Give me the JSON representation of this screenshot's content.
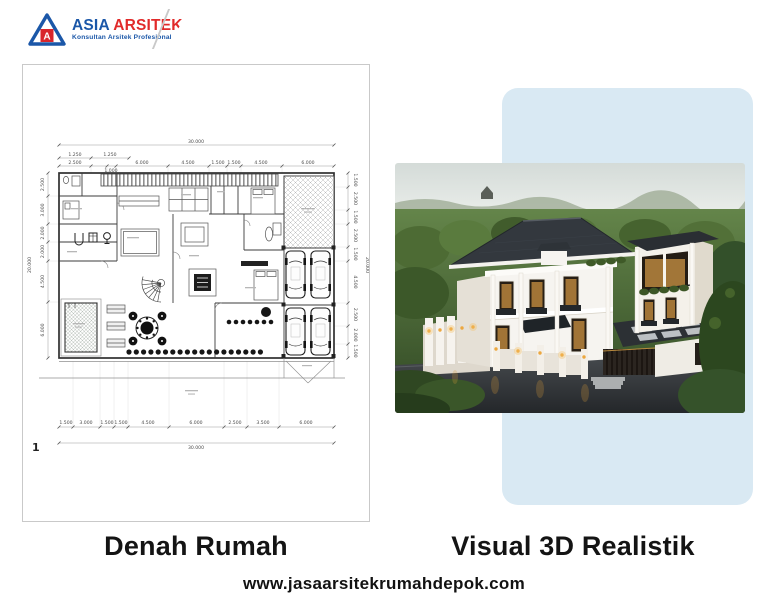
{
  "logo": {
    "mark_letter": "A",
    "brand_first": "ASIA",
    "brand_second": "ARSITEK",
    "tagline": "Konsultan Arsitek Profesional",
    "colors": {
      "blue": "#1b57a8",
      "red": "#e12a2a"
    }
  },
  "plan": {
    "sheet_number": "1",
    "width_total": "30.000",
    "height_total": "20.000",
    "top_sub_dims": [
      "1.250",
      "1.250"
    ],
    "top_offset_dim": "1.000",
    "top_dims": [
      "2.500",
      "6.000",
      "4.500",
      "1.500",
      "1.500",
      "4.500",
      "6.000"
    ],
    "bottom_dims": [
      "1.500",
      "3.000",
      "1.500",
      "1.500",
      "4.500",
      "6.000",
      "2.500",
      "3.500",
      "6.000"
    ],
    "left_dims": [
      "2.500",
      "3.000",
      "2.000",
      "2.000",
      "4.500",
      "6.000"
    ],
    "right_dims": [
      "1.500",
      "2.500",
      "1.500",
      "2.500",
      "1.500",
      "4.500",
      "2.500",
      "2.000",
      "1.500"
    ]
  },
  "captions": {
    "left": "Denah Rumah",
    "right": "Visual 3D Realistik"
  },
  "footer": {
    "website": "www.jasaarsitekrumahdepok.com"
  },
  "colors": {
    "panel_blue": "#d9e9f3",
    "caption_text": "#141414"
  }
}
